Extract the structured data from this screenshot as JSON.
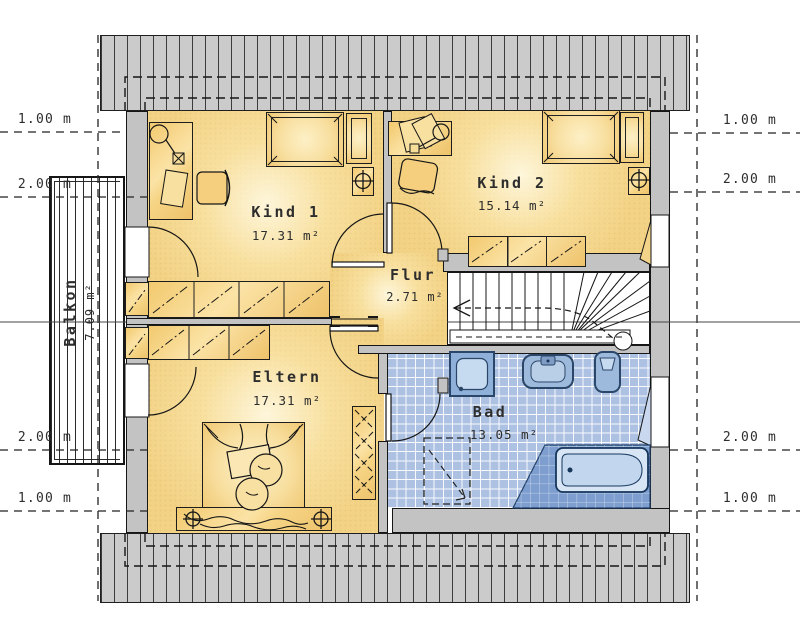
{
  "plan": {
    "type": "floor-plan",
    "rooms": {
      "kind1": {
        "name": "Kind 1",
        "area": "17.31 m²"
      },
      "kind2": {
        "name": "Kind 2",
        "area": "15.14 m²"
      },
      "flur": {
        "name": "Flur",
        "area": "2.71 m²"
      },
      "eltern": {
        "name": "Eltern",
        "area": "17.31 m²"
      },
      "bad": {
        "name": "Bad",
        "area": "13.05 m²"
      },
      "balkon": {
        "name": "Balkon",
        "area": "7.09 m²"
      }
    },
    "dimensions": {
      "tl1": "1.00 m",
      "tl2": "2.00 m",
      "tr1": "1.00 m",
      "tr2": "2.00 m",
      "bl2": "2.00 m",
      "bl1": "1.00 m",
      "br2": "2.00 m",
      "br1": "1.00 m"
    },
    "icons": {
      "lamp_symbol": "circle-with-cross",
      "stair_walk_line": "dashed-arrow",
      "wardrobe_doors": "dash-dot-diagonal"
    },
    "colors": {
      "room_fill": "#f3d488",
      "furniture": "#f5cf7d",
      "wall": "#c3c3c3",
      "roof_strip": "#cbcbcb",
      "bath_tile": "#adc2e2",
      "fixture": "#9db9dc",
      "fixture_dark": "#2a4668",
      "tub_platform": "#7d9ecf",
      "line": "#1a1a1a"
    }
  }
}
